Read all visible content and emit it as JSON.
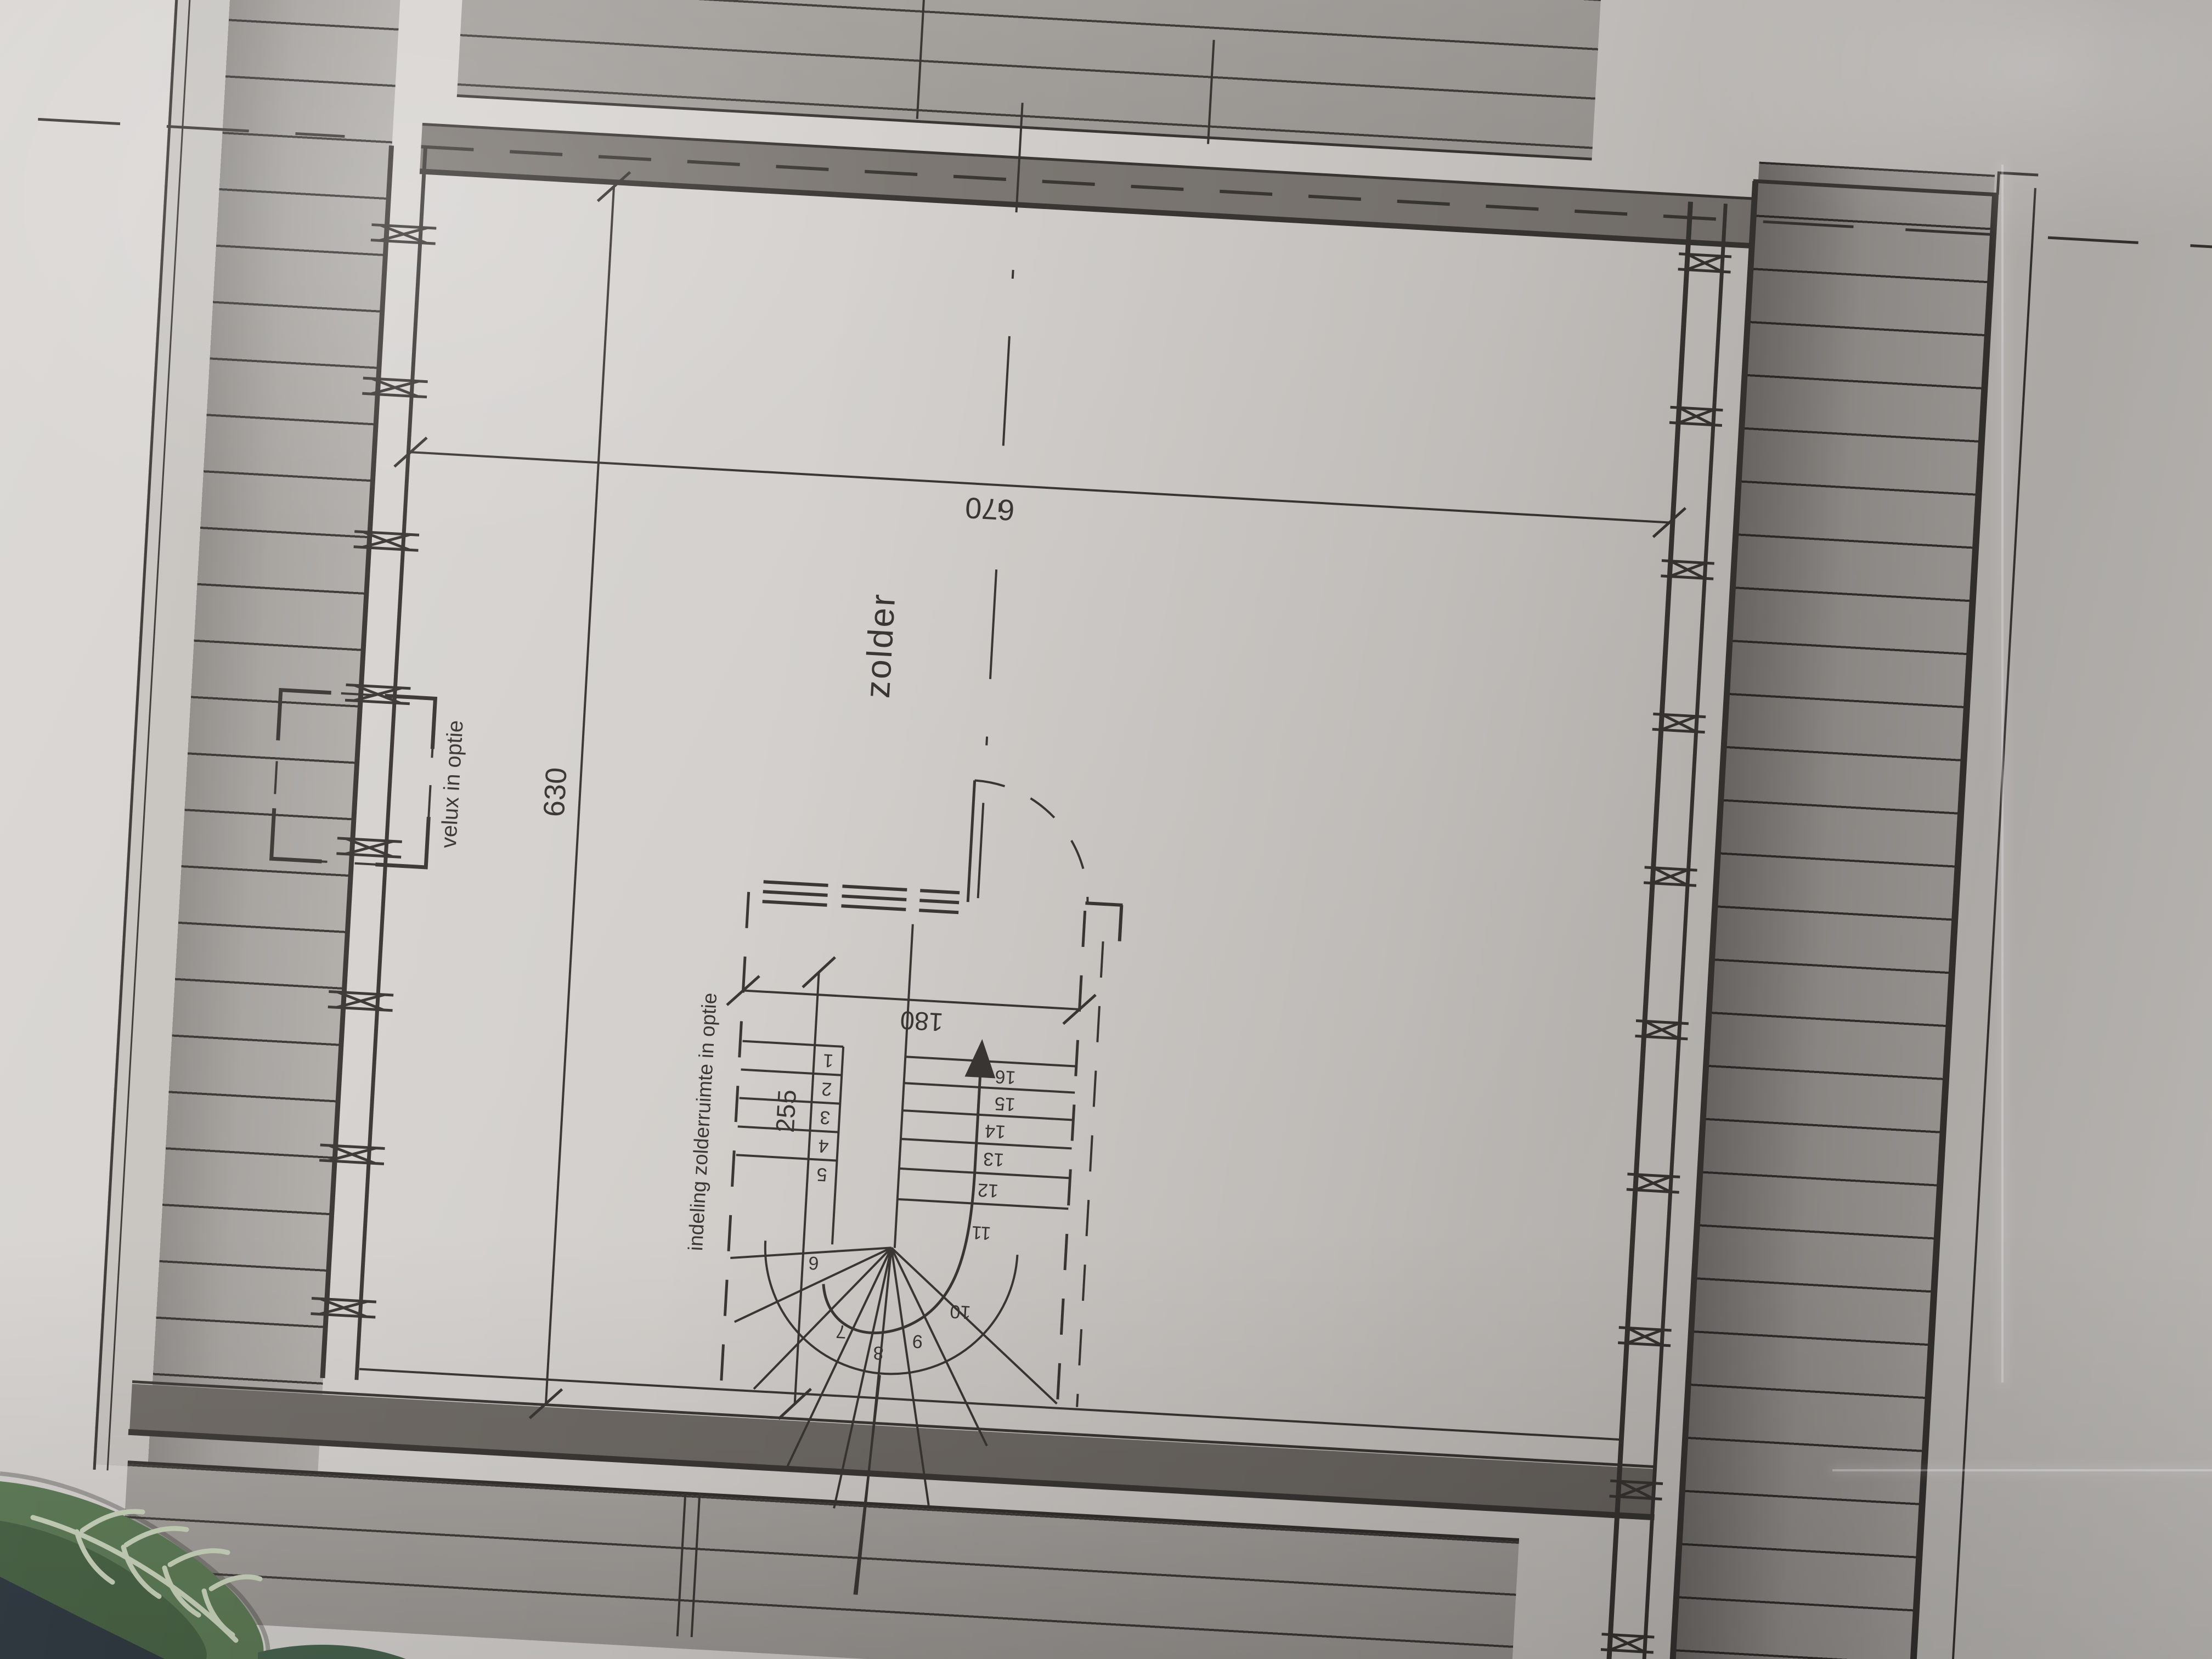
{
  "drawing": {
    "room_label": "zolder",
    "labels": {
      "velux_option": "velux in optie",
      "attic_layout_option": "indeling zolderruimte in optie"
    },
    "dimensions": {
      "overall_width": "670",
      "overall_depth": "630",
      "stair_length": "255",
      "stair_width": "180"
    },
    "stairs": {
      "step_numbers": [
        "1",
        "2",
        "3",
        "4",
        "5",
        "6",
        "7",
        "8",
        "9",
        "10",
        "11",
        "12",
        "13",
        "14",
        "15",
        "16"
      ]
    }
  },
  "colors": {
    "paper": "#d3d0cd",
    "ink": "#3a3734",
    "roof_hatch_fill": "#9b9793",
    "wall_band_dark": "#7d7873",
    "plant_leaf": "#5a7852",
    "plant_vein": "#c8d3ba",
    "plant_shadow": "#2b353d"
  }
}
